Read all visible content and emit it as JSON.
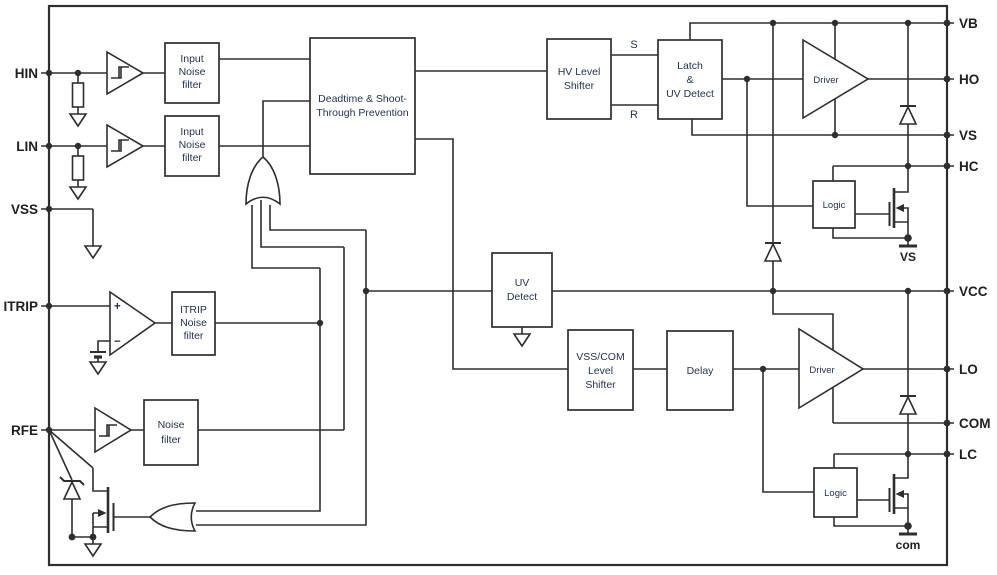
{
  "diagram": {
    "blocks": {
      "hin_filter": {
        "lines": [
          "Input",
          "Noise",
          "filter"
        ]
      },
      "lin_filter": {
        "lines": [
          "Input",
          "Noise",
          "filter"
        ]
      },
      "deadtime": {
        "lines": [
          "Deadtime & Shoot-",
          "Through Prevention"
        ]
      },
      "hv_level_shifter": {
        "lines": [
          "HV Level",
          "Shifter"
        ]
      },
      "latch_uv": {
        "lines": [
          "Latch",
          "&",
          "UV Detect"
        ]
      },
      "uv_detect": {
        "lines": [
          "UV",
          "Detect"
        ]
      },
      "vss_com_shifter": {
        "lines": [
          "VSS/COM",
          "Level",
          "Shifter"
        ]
      },
      "delay": {
        "label": "Delay"
      },
      "itrip_filter": {
        "lines": [
          "ITRIP",
          "Noise",
          "filter"
        ]
      },
      "rfe_filter": {
        "lines": [
          "Noise",
          "filter"
        ]
      },
      "driver_high": {
        "label": "Driver"
      },
      "driver_low": {
        "label": "Driver"
      },
      "logic_high": {
        "label": "Logic"
      },
      "logic_low": {
        "label": "Logic"
      }
    },
    "pins": {
      "left": [
        {
          "name": "HIN"
        },
        {
          "name": "LIN"
        },
        {
          "name": "VSS"
        },
        {
          "name": "ITRIP"
        },
        {
          "name": "RFE"
        }
      ],
      "right": [
        {
          "name": "VB"
        },
        {
          "name": "HO"
        },
        {
          "name": "VS"
        },
        {
          "name": "HC"
        },
        {
          "name": "VCC"
        },
        {
          "name": "LO"
        },
        {
          "name": "COM"
        },
        {
          "name": "LC"
        }
      ]
    },
    "net_labels": {
      "set": "S",
      "reset": "R",
      "vs_tap": "VS",
      "com_tap": "com"
    },
    "comparator": {
      "plus": "+",
      "minus": "−"
    },
    "colors": {
      "line": "#2e2e2e",
      "block_text": "#24344f",
      "pin_text": "#21201e",
      "background": "#ffffff"
    }
  }
}
